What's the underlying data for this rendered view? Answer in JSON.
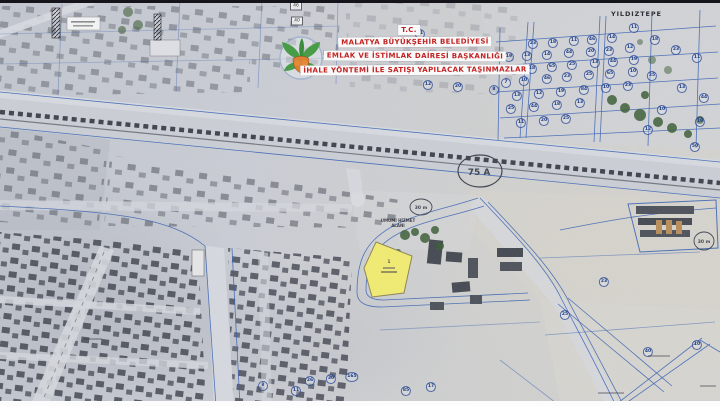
{
  "document": {
    "kind": "scanned cadastral aerial map",
    "municipality": "Malatya"
  },
  "map_title_block": {
    "line1": "T.C.",
    "line2": "MALATYA BÜYÜKŞEHİR BELEDİYESİ",
    "line3": "EMLAK VE İSTİMLAK DAİRESİ BAŞKANLIĞI",
    "line4": "İHALE YÖNTEMİ İLE SATIŞI YAPILACAK TAŞINMAZLAR"
  },
  "region_label": "YILDIZTEPE",
  "road_labels": {
    "highway_ellipse": "75 A",
    "left_ellipse": "30 m",
    "right_ellipse": "30 m"
  },
  "area_label": {
    "line1": "UMUMİ HİZMET",
    "line2": "ALANI"
  },
  "highlight_parcel": {
    "number": "1",
    "fill_color": "#f4ee6e"
  },
  "logo": {
    "name": "malatya-municipality-logo",
    "green": "#3f9a3d",
    "orange": "#e07b25"
  },
  "colors": {
    "title_text": "#c32222",
    "cadastral_line": "#2d5ab2",
    "railway": "#3d414a",
    "highlight_yellow": "#f4ee6e"
  },
  "parcel_markers": [
    {
      "x": 533,
      "y": 44,
      "label": "23"
    },
    {
      "x": 553,
      "y": 43,
      "label": "18"
    },
    {
      "x": 574,
      "y": 41,
      "label": "11"
    },
    {
      "x": 592,
      "y": 40,
      "label": "46"
    },
    {
      "x": 612,
      "y": 38,
      "label": "14"
    },
    {
      "x": 509,
      "y": 57,
      "label": "19"
    },
    {
      "x": 527,
      "y": 56,
      "label": "13"
    },
    {
      "x": 547,
      "y": 55,
      "label": "14"
    },
    {
      "x": 569,
      "y": 53,
      "label": "44"
    },
    {
      "x": 591,
      "y": 52,
      "label": "20"
    },
    {
      "x": 609,
      "y": 51,
      "label": "23"
    },
    {
      "x": 630,
      "y": 48,
      "label": "12"
    },
    {
      "x": 514,
      "y": 70,
      "label": "11"
    },
    {
      "x": 532,
      "y": 69,
      "label": "18"
    },
    {
      "x": 552,
      "y": 67,
      "label": "65"
    },
    {
      "x": 572,
      "y": 65,
      "label": "25"
    },
    {
      "x": 595,
      "y": 63,
      "label": "13"
    },
    {
      "x": 613,
      "y": 62,
      "label": "44"
    },
    {
      "x": 634,
      "y": 60,
      "label": "19"
    },
    {
      "x": 506,
      "y": 83,
      "label": "7"
    },
    {
      "x": 524,
      "y": 81,
      "label": "10"
    },
    {
      "x": 547,
      "y": 79,
      "label": "46"
    },
    {
      "x": 567,
      "y": 77,
      "label": "23"
    },
    {
      "x": 589,
      "y": 75,
      "label": "25"
    },
    {
      "x": 610,
      "y": 74,
      "label": "65"
    },
    {
      "x": 633,
      "y": 72,
      "label": "10"
    },
    {
      "x": 517,
      "y": 96,
      "label": "13"
    },
    {
      "x": 539,
      "y": 94,
      "label": "12"
    },
    {
      "x": 561,
      "y": 92,
      "label": "19"
    },
    {
      "x": 584,
      "y": 90,
      "label": "84"
    },
    {
      "x": 606,
      "y": 88,
      "label": "10"
    },
    {
      "x": 628,
      "y": 86,
      "label": "23"
    },
    {
      "x": 511,
      "y": 109,
      "label": "25"
    },
    {
      "x": 534,
      "y": 107,
      "label": "44"
    },
    {
      "x": 557,
      "y": 105,
      "label": "18"
    },
    {
      "x": 580,
      "y": 103,
      "label": "13"
    },
    {
      "x": 521,
      "y": 123,
      "label": "11"
    },
    {
      "x": 544,
      "y": 121,
      "label": "20"
    },
    {
      "x": 566,
      "y": 119,
      "label": "25"
    },
    {
      "x": 655,
      "y": 40,
      "label": "18"
    },
    {
      "x": 676,
      "y": 50,
      "label": "23"
    },
    {
      "x": 697,
      "y": 58,
      "label": "11"
    },
    {
      "x": 652,
      "y": 76,
      "label": "25"
    },
    {
      "x": 682,
      "y": 88,
      "label": "13"
    },
    {
      "x": 704,
      "y": 98,
      "label": "44"
    },
    {
      "x": 662,
      "y": 110,
      "label": "10"
    },
    {
      "x": 700,
      "y": 122,
      "label": "19"
    },
    {
      "x": 648,
      "y": 130,
      "label": "12"
    },
    {
      "x": 695,
      "y": 147,
      "label": "50"
    },
    {
      "x": 634,
      "y": 28,
      "label": "11"
    },
    {
      "x": 428,
      "y": 85,
      "label": "12"
    },
    {
      "x": 458,
      "y": 87,
      "label": "20"
    },
    {
      "x": 494,
      "y": 90,
      "label": "8"
    },
    {
      "x": 420,
      "y": 34,
      "label": "31"
    },
    {
      "x": 310,
      "y": 381,
      "label": "26"
    },
    {
      "x": 331,
      "y": 379,
      "label": "30"
    },
    {
      "x": 352,
      "y": 377,
      "label": "165"
    },
    {
      "x": 296,
      "y": 391,
      "label": "11"
    },
    {
      "x": 263,
      "y": 386,
      "label": "8"
    },
    {
      "x": 406,
      "y": 391,
      "label": "85"
    },
    {
      "x": 431,
      "y": 387,
      "label": "17"
    },
    {
      "x": 697,
      "y": 345,
      "label": "10"
    },
    {
      "x": 648,
      "y": 352,
      "label": "40"
    },
    {
      "x": 565,
      "y": 315,
      "label": "25"
    },
    {
      "x": 604,
      "y": 282,
      "label": "23"
    }
  ],
  "box_markers": [
    {
      "x": 296,
      "y": 6,
      "label": "46"
    },
    {
      "x": 297,
      "y": 21,
      "label": "40"
    }
  ]
}
